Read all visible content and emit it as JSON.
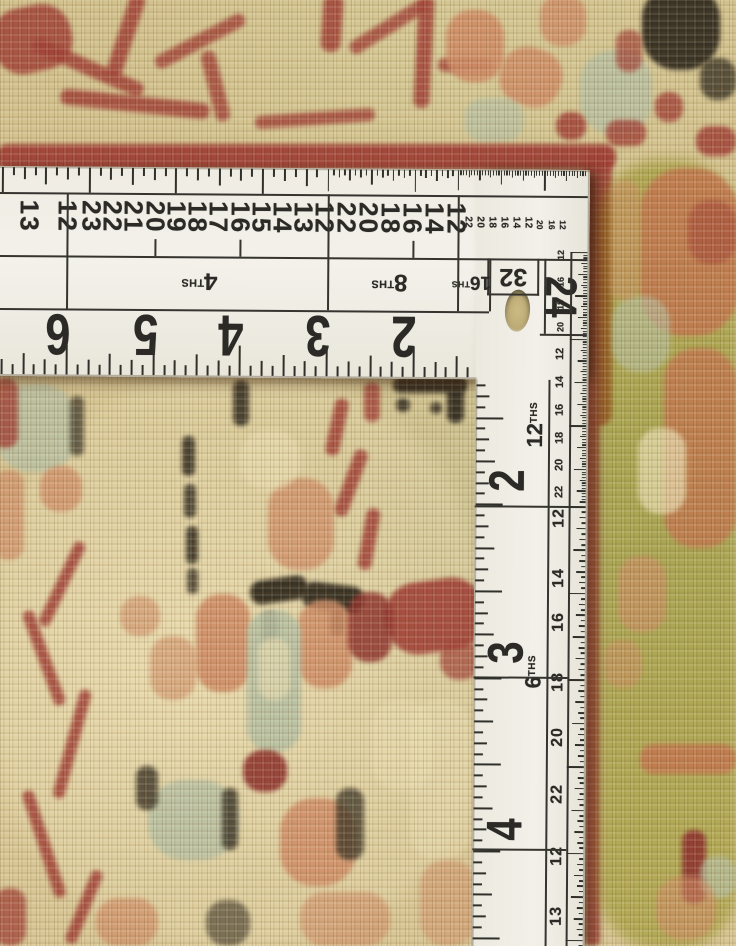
{
  "subject": {
    "scene_label": "rug with L-square ruler"
  },
  "palette": {
    "rug_tan": "#d3c28c",
    "rug_cream": "#e8dcb0",
    "rug_olive": "#b9b98c",
    "red": "#9d382f",
    "dark_red": "#8a2b26",
    "salmon": "#cd8760",
    "rust": "#c07048",
    "sage": "#b3bda0",
    "dark": "#30291c",
    "ruler_white": "#efece3",
    "marking": "#2d2c28"
  },
  "ruler": {
    "corner_number": {
      "t": "24"
    },
    "box32_label": "32",
    "horizontal": {
      "top_numbers": [
        {
          "t": "13",
          "x": 30,
          "s": "lg"
        },
        {
          "t": "12",
          "x": 68,
          "s": "lg"
        },
        {
          "t": "23",
          "x": 92,
          "s": "lg"
        },
        {
          "t": "22",
          "x": 113,
          "s": "lg"
        },
        {
          "t": "21",
          "x": 134,
          "s": "lg"
        },
        {
          "t": "20",
          "x": 156,
          "s": "lg"
        },
        {
          "t": "19",
          "x": 177,
          "s": "lg"
        },
        {
          "t": "18",
          "x": 198,
          "s": "lg"
        },
        {
          "t": "17",
          "x": 219,
          "s": "lg"
        },
        {
          "t": "16",
          "x": 241,
          "s": "lg"
        },
        {
          "t": "15",
          "x": 262,
          "s": "lg"
        },
        {
          "t": "14",
          "x": 283,
          "s": "lg"
        },
        {
          "t": "13",
          "x": 304,
          "s": "lg"
        },
        {
          "t": "12",
          "x": 325,
          "s": "lg"
        },
        {
          "t": "22",
          "x": 347,
          "s": "lg"
        },
        {
          "t": "20",
          "x": 369,
          "s": "lg"
        },
        {
          "t": "18",
          "x": 391,
          "s": "lg"
        },
        {
          "t": "16",
          "x": 413,
          "s": "lg"
        },
        {
          "t": "14",
          "x": 435,
          "s": "lg"
        },
        {
          "t": "12",
          "x": 457,
          "s": "lg"
        },
        {
          "t": "22",
          "x": 468,
          "s": "sm"
        },
        {
          "t": "20",
          "x": 480,
          "s": "sm"
        },
        {
          "t": "18",
          "x": 492,
          "s": "sm"
        },
        {
          "t": "16",
          "x": 504,
          "s": "sm"
        },
        {
          "t": "14",
          "x": 516,
          "s": "sm"
        },
        {
          "t": "12",
          "x": 528,
          "s": "sm"
        },
        {
          "t": "20",
          "x": 540,
          "s": "xs"
        },
        {
          "t": "16",
          "x": 552,
          "s": "xs"
        },
        {
          "t": "12",
          "x": 563,
          "s": "xs"
        }
      ],
      "ths_labels": [
        {
          "label": "4",
          "suffix": "THS",
          "cx": 200,
          "small": false
        },
        {
          "label": "8",
          "suffix": "THS",
          "cx": 390,
          "small": false
        },
        {
          "label": "16",
          "suffix": "THS",
          "cx": 472,
          "small": true
        }
      ],
      "inch_numbers": [
        {
          "t": "6",
          "cx": 59
        },
        {
          "t": "5",
          "cx": 147
        },
        {
          "t": "4",
          "cx": 232
        },
        {
          "t": "3",
          "cx": 319
        },
        {
          "t": "2",
          "cx": 405
        }
      ]
    },
    "vertical": {
      "ths_labels": [
        {
          "label": "12",
          "suffix": "THS",
          "cy": 421
        },
        {
          "label": "6",
          "suffix": "THS",
          "cy": 668
        }
      ],
      "inch_numbers": [
        {
          "t": "2",
          "cy": 477
        },
        {
          "t": "3",
          "cy": 649
        },
        {
          "t": "4",
          "cy": 826
        }
      ],
      "edge_numbers": [
        {
          "t": "12",
          "y": 251,
          "s": "xs"
        },
        {
          "t": "16",
          "y": 278,
          "s": "xs"
        },
        {
          "t": "18",
          "y": 301,
          "s": "xs"
        },
        {
          "t": "20",
          "y": 323,
          "s": "xs"
        },
        {
          "t": "12",
          "y": 350,
          "s": "sm"
        },
        {
          "t": "14",
          "y": 378,
          "s": "sm"
        },
        {
          "t": "16",
          "y": 406,
          "s": "sm"
        },
        {
          "t": "18",
          "y": 434,
          "s": "sm"
        },
        {
          "t": "20",
          "y": 461,
          "s": "sm"
        },
        {
          "t": "22",
          "y": 488,
          "s": "sm"
        },
        {
          "t": "12",
          "y": 514,
          "s": "md"
        },
        {
          "t": "14",
          "y": 574,
          "s": "md"
        },
        {
          "t": "16",
          "y": 618,
          "s": "md"
        },
        {
          "t": "18",
          "y": 678,
          "s": "md"
        },
        {
          "t": "20",
          "y": 733,
          "s": "md"
        },
        {
          "t": "22",
          "y": 790,
          "s": "md"
        },
        {
          "t": "12",
          "y": 852,
          "s": "md"
        },
        {
          "t": "13",
          "y": 912,
          "s": "md"
        }
      ]
    }
  }
}
